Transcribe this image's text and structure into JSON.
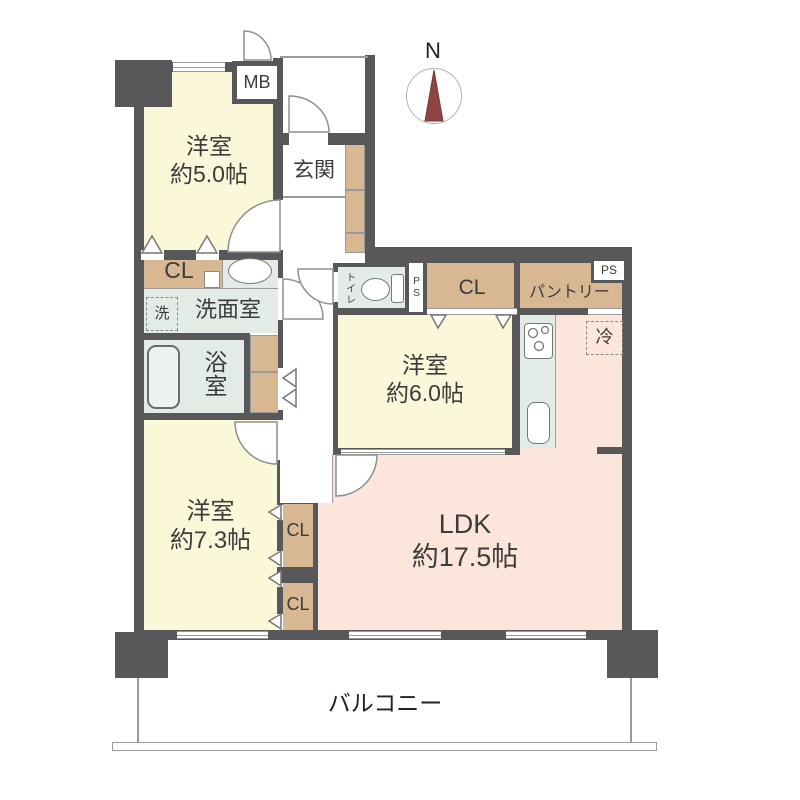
{
  "title": "マンション間取り図 3LDK",
  "compass": {
    "north": "N"
  },
  "labels": {
    "mb": "MB",
    "genkan": "玄関",
    "room5_name": "洋室",
    "room5_size": "約5.0帖",
    "cl": "CL",
    "washer": "洗",
    "washroom": "洗面室",
    "bath": "浴室",
    "toilet": "トイレ",
    "ps": "PS",
    "pantry": "パントリー",
    "fridge": "冷",
    "room6_name": "洋室",
    "room6_size": "約6.0帖",
    "room7_name": "洋室",
    "room7_size": "約7.3帖",
    "ldk_name": "LDK",
    "ldk_size": "約17.5帖",
    "balcony": "バルコニー"
  },
  "colors": {
    "wall": "#58585a",
    "room_cream": "#fbf7d9",
    "ldk_pink": "#fce5db",
    "wood_tan": "#d7b892",
    "wet_green": "#e2ebe5",
    "line_gray": "#9a9a9a",
    "north_red": "#8c4540",
    "text": "#3c3c3c"
  }
}
